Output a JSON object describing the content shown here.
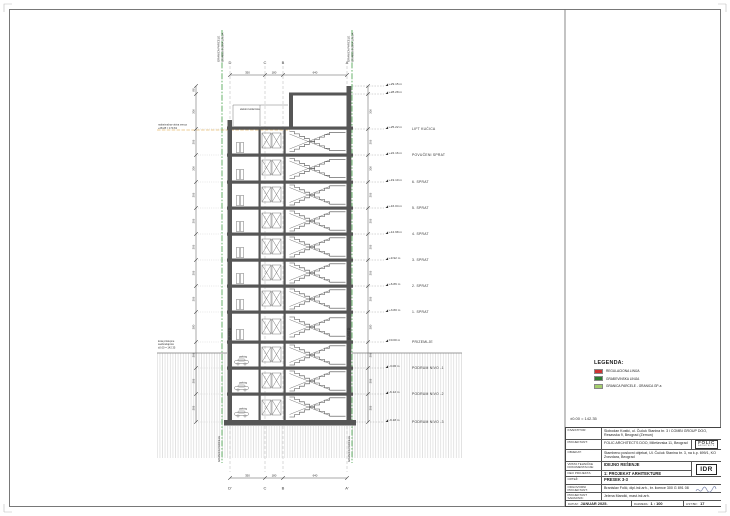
{
  "colors": {
    "green": "#43a047",
    "dgreen": "#2e7d32",
    "lgreen": "#a5cf6e",
    "red": "#cc3333",
    "orange": "#d99a2b"
  },
  "notes": {
    "datum": "±0.00 = 142.35"
  },
  "legend": {
    "title": "LEGENDA:",
    "items": [
      {
        "label": "REGULACIONA LINIJA",
        "color": "#cc3333"
      },
      {
        "label": "GRAĐEVINSKA LINIJA",
        "color": "#2e7d32"
      },
      {
        "label": "GRANICA PARCELE - GRANICA GP-a",
        "color": "#a5cf6e"
      }
    ]
  },
  "drawing": {
    "grid_top": [
      "D",
      "C",
      "B",
      "A"
    ],
    "grid_bottom": [
      "D'",
      "C",
      "B",
      "A'"
    ],
    "dims_top": [
      "350",
      "180",
      "640"
    ],
    "dims_bottom": [
      "350",
      "180",
      "640"
    ],
    "dim_306": "306",
    "dim_380": "380",
    "dim_88": "88",
    "neighbor_label": "SUSED",
    "parking_label": "parking",
    "roof_note": "elektro kotlarnica",
    "cornice_note_1": "maksimalna visina venca",
    "cornice_note_2": "+28.28 = 170.63",
    "terrain_note_1": "kota pristupne",
    "terrain_note_2": "saobraćajnice",
    "terrain_note_3": "±0.00 = 142.35",
    "boundary_label_1": "GRANICA PARCELE",
    "boundary_label_2": "GRAĐEVINSKA LINIJA",
    "levels": [
      {
        "elev": "+29.15 m",
        "name": ""
      },
      {
        "elev": "+28.28 m",
        "name": ""
      },
      {
        "elev": "+25.22 m",
        "name": "LIFT KUĆICA"
      },
      {
        "elev": "+22.16 m",
        "name": "POVUČENI SPRAT"
      },
      {
        "elev": "+19.10 m",
        "name": "6. SPRAT"
      },
      {
        "elev": "+16.04 m",
        "name": "5. SPRAT"
      },
      {
        "elev": "+12.98 m",
        "name": "4. SPRAT"
      },
      {
        "elev": "+9.92 m",
        "name": "3. SPRAT"
      },
      {
        "elev": "+6.86 m",
        "name": "2. SPRAT"
      },
      {
        "elev": "+3.80 m",
        "name": "1. SPRAT"
      },
      {
        "elev": "±0.00 m",
        "name": "PRIZEMLJE"
      },
      {
        "elev": "-3.06 m",
        "name": "PODRUM NIVO -1"
      },
      {
        "elev": "-6.12 m",
        "name": "PODRUM NIVO -2"
      },
      {
        "elev": "-9.18 m",
        "name": "PODRUM NIVO -3"
      }
    ]
  },
  "titleblock": {
    "rows": [
      {
        "label": "INVESTITOR:",
        "value": "Slobodan Kostić, ul. Čučuk Stanina br. 3 i COMBI GROUP DOO, Resavska 9, Beograd (Zemun)"
      },
      {
        "label": "PROJEKTANT:",
        "value": "FOLIC ARCHITECTS DOO, Mileševska 11, Beograd"
      },
      {
        "label": "OBJEKAT:",
        "value": "Stambeno poslovni objekat, Ul. Čučuk Stanina br. 3, na k.p. 699/1, KO Zvezdara, Beograd"
      },
      {
        "label": "VRSTA TEHNIČKE DOKUMENTACIJE:",
        "value": "IDEJNO REŠENJE"
      },
      {
        "label": "DEO PROJEKTA:",
        "value": "1: PROJEKAT ARHITEKTURE"
      },
      {
        "label": "CRTEŽ:",
        "value": "PRESEK 3-3"
      },
      {
        "label": "ODGOVORNI PROJEKTANT:",
        "value": "Branislav Folić, dipl.inž.arh., br. licence 300 G 891 08"
      },
      {
        "label": "PROJEKTANT SARADNIK:",
        "value": "Jelena Mandić, mast.inž.arh."
      }
    ],
    "stamp": "IDR",
    "logo_line1": "FOLIC",
    "logo_line2": "ARCHITECTS",
    "footer": {
      "date_label": "DATUM:",
      "date": "JANUAR 2025.",
      "scale_label": "RAZMERA:",
      "scale": "1 : 100",
      "sheet_label": "LIST BR.:",
      "sheet": "17"
    }
  }
}
